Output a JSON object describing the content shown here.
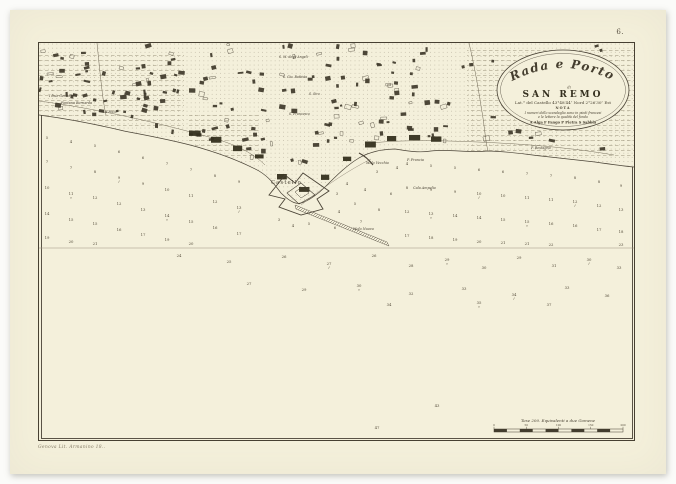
{
  "page": {
    "plate_number": "6.",
    "imprint": "Genova Lit. Armanino 18..",
    "background_color": "#fbfbf9",
    "sheet_color": "#f4f0db",
    "ink_color": "#474032"
  },
  "cartouche": {
    "title_line1": "Rada e Porto",
    "title_line2": "di",
    "title_line3": "SAN REMO",
    "latitude_line": "Lat.° del Castello 43°48′44″ Nord 2°26′30″ Est",
    "nota_heading": "NOTA",
    "nota_line1": "I numeri dello scandaglio sono in piedi francesi",
    "nota_line2": "e le lettere la qualità del fondo",
    "legend_line": "A Alga   F Fango   P Pietra   S Sabbia"
  },
  "scale_bar": {
    "caption": "Tese 200. Equivalenti a due Gomene",
    "tick_labels": [
      "0",
      "50",
      "100",
      "150",
      "200"
    ]
  },
  "map": {
    "fold_line_y": 205,
    "labels": [
      {
        "text": "I Due Gemelli",
        "x": 10,
        "y": 54,
        "size": 3.4,
        "italic": true
      },
      {
        "text": "Fontana Bernarda",
        "x": 22,
        "y": 61,
        "size": 3.4,
        "italic": true
      },
      {
        "text": "La Foce",
        "x": 64,
        "y": 70,
        "size": 3.4,
        "italic": true
      },
      {
        "text": "S. M. degli Angeli",
        "x": 240,
        "y": 15,
        "size": 3.2,
        "italic": true
      },
      {
        "text": "S. Gio. Battista",
        "x": 244,
        "y": 35,
        "size": 3.2,
        "italic": true
      },
      {
        "text": "S. Siro",
        "x": 270,
        "y": 52,
        "size": 3.2,
        "italic": true
      },
      {
        "text": "S. Francesco",
        "x": 250,
        "y": 72,
        "size": 3.2,
        "italic": true
      },
      {
        "text": "Castello",
        "x": 232,
        "y": 141,
        "size": 5.2,
        "italic": false
      },
      {
        "text": "Molo Vecchio",
        "x": 327,
        "y": 121,
        "size": 3.4,
        "italic": true
      },
      {
        "text": "Molo Nuovo",
        "x": 314,
        "y": 187,
        "size": 3.4,
        "italic": true
      },
      {
        "text": "Cala Ampelio",
        "x": 374,
        "y": 146,
        "size": 3.4,
        "italic": true
      },
      {
        "text": "P. Francia",
        "x": 368,
        "y": 118,
        "size": 3.4,
        "italic": true
      },
      {
        "text": "P. Bestagno",
        "x": 492,
        "y": 106,
        "size": 3.4,
        "italic": true
      }
    ],
    "soundings": [
      [
        8,
        96,
        "5"
      ],
      [
        8,
        120,
        "7"
      ],
      [
        8,
        146,
        "10"
      ],
      [
        8,
        172,
        "14"
      ],
      [
        8,
        196,
        "19"
      ],
      [
        32,
        100,
        "4"
      ],
      [
        32,
        126,
        "7"
      ],
      [
        32,
        152,
        "11",
        "s"
      ],
      [
        32,
        178,
        "15"
      ],
      [
        32,
        200,
        "20"
      ],
      [
        56,
        104,
        "5"
      ],
      [
        56,
        130,
        "8"
      ],
      [
        56,
        156,
        "12"
      ],
      [
        56,
        182,
        "15"
      ],
      [
        56,
        202,
        "21"
      ],
      [
        80,
        110,
        "6"
      ],
      [
        80,
        136,
        "9",
        "f"
      ],
      [
        80,
        162,
        "12"
      ],
      [
        80,
        188,
        "16"
      ],
      [
        104,
        116,
        "6"
      ],
      [
        104,
        142,
        "9"
      ],
      [
        104,
        168,
        "13"
      ],
      [
        104,
        193,
        "17"
      ],
      [
        128,
        122,
        "7"
      ],
      [
        128,
        148,
        "10"
      ],
      [
        128,
        174,
        "14",
        "s"
      ],
      [
        128,
        198,
        "19"
      ],
      [
        152,
        128,
        "7"
      ],
      [
        152,
        154,
        "11"
      ],
      [
        152,
        180,
        "15"
      ],
      [
        152,
        202,
        "20"
      ],
      [
        176,
        134,
        "8"
      ],
      [
        176,
        160,
        "12"
      ],
      [
        176,
        186,
        "16"
      ],
      [
        200,
        140,
        "9"
      ],
      [
        200,
        166,
        "13",
        "f"
      ],
      [
        200,
        192,
        "17"
      ],
      [
        240,
        178,
        "3"
      ],
      [
        254,
        184,
        "4"
      ],
      [
        270,
        182,
        "5"
      ],
      [
        300,
        170,
        "4"
      ],
      [
        298,
        152,
        "3"
      ],
      [
        308,
        142,
        "4"
      ],
      [
        296,
        186,
        "6"
      ],
      [
        316,
        162,
        "5"
      ],
      [
        326,
        148,
        "4"
      ],
      [
        322,
        180,
        "7"
      ],
      [
        340,
        168,
        "8"
      ],
      [
        352,
        152,
        "6"
      ],
      [
        338,
        130,
        "3"
      ],
      [
        358,
        126,
        "4"
      ],
      [
        368,
        122,
        "4"
      ],
      [
        368,
        146,
        "8"
      ],
      [
        368,
        170,
        "12"
      ],
      [
        368,
        194,
        "17"
      ],
      [
        392,
        124,
        "5"
      ],
      [
        392,
        148,
        "9"
      ],
      [
        392,
        172,
        "13",
        "s"
      ],
      [
        392,
        196,
        "18"
      ],
      [
        416,
        126,
        "5"
      ],
      [
        416,
        150,
        "9"
      ],
      [
        416,
        174,
        "14"
      ],
      [
        416,
        198,
        "19"
      ],
      [
        440,
        128,
        "6"
      ],
      [
        440,
        152,
        "10",
        "f"
      ],
      [
        440,
        176,
        "14"
      ],
      [
        440,
        200,
        "20"
      ],
      [
        464,
        130,
        "6"
      ],
      [
        464,
        154,
        "10"
      ],
      [
        464,
        178,
        "15"
      ],
      [
        464,
        201,
        "21"
      ],
      [
        488,
        132,
        "7"
      ],
      [
        488,
        156,
        "11"
      ],
      [
        488,
        180,
        "15",
        "s"
      ],
      [
        488,
        202,
        "21"
      ],
      [
        512,
        134,
        "7"
      ],
      [
        512,
        158,
        "11"
      ],
      [
        512,
        182,
        "16"
      ],
      [
        512,
        203,
        "22"
      ],
      [
        536,
        136,
        "8"
      ],
      [
        536,
        160,
        "12",
        "f"
      ],
      [
        536,
        184,
        "16"
      ],
      [
        560,
        140,
        "8"
      ],
      [
        560,
        164,
        "12"
      ],
      [
        560,
        188,
        "17"
      ],
      [
        582,
        144,
        "9"
      ],
      [
        582,
        168,
        "13"
      ],
      [
        582,
        190,
        "18"
      ],
      [
        582,
        203,
        "23"
      ],
      [
        140,
        214,
        "24"
      ],
      [
        190,
        220,
        "25"
      ],
      [
        245,
        215,
        "26"
      ],
      [
        290,
        222,
        "27",
        "f"
      ],
      [
        335,
        214,
        "26"
      ],
      [
        372,
        224,
        "28"
      ],
      [
        408,
        218,
        "29",
        "s"
      ],
      [
        445,
        226,
        "30"
      ],
      [
        480,
        216,
        "29"
      ],
      [
        515,
        224,
        "31"
      ],
      [
        550,
        218,
        "30",
        "f"
      ],
      [
        580,
        226,
        "33"
      ],
      [
        210,
        242,
        "27"
      ],
      [
        265,
        248,
        "29"
      ],
      [
        320,
        244,
        "30",
        "s"
      ],
      [
        372,
        252,
        "32"
      ],
      [
        425,
        247,
        "33"
      ],
      [
        475,
        253,
        "34",
        "f"
      ],
      [
        528,
        246,
        "33"
      ],
      [
        568,
        254,
        "36"
      ],
      [
        350,
        263,
        "34"
      ],
      [
        440,
        261,
        "35",
        "s"
      ],
      [
        510,
        263,
        "37"
      ],
      [
        338,
        386,
        "47"
      ],
      [
        398,
        364,
        "43"
      ]
    ]
  }
}
